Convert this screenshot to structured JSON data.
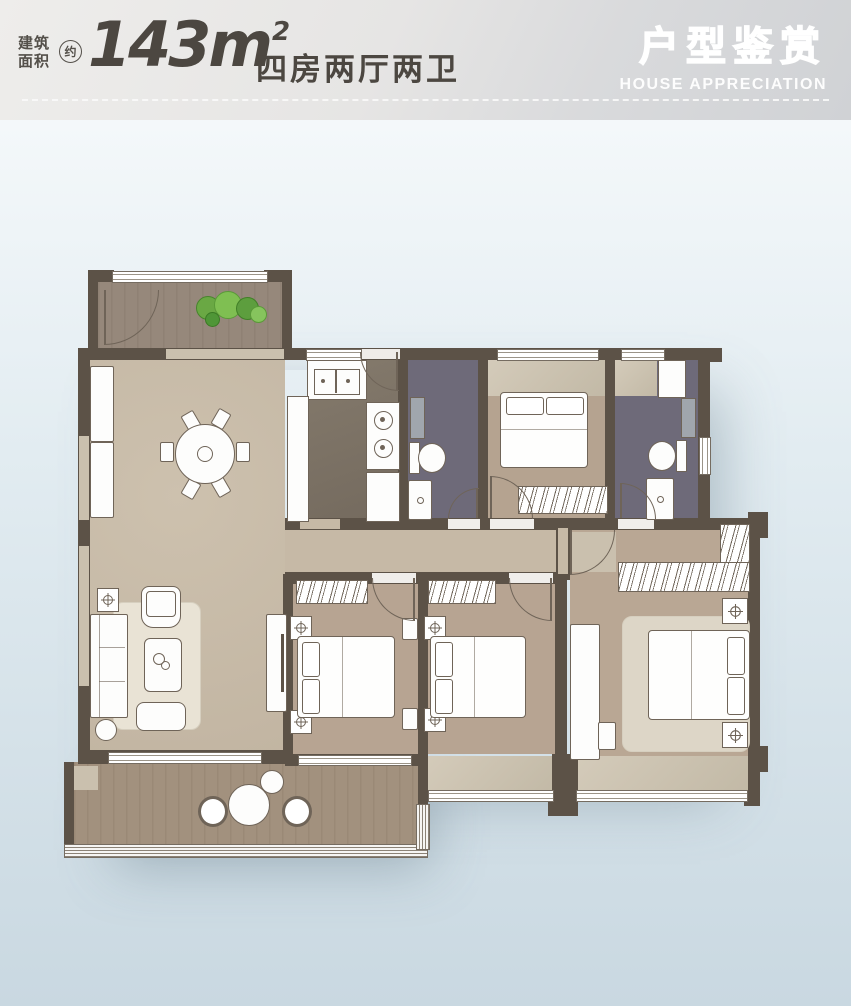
{
  "header": {
    "area_label": [
      "建筑",
      "面积"
    ],
    "approx": "约",
    "area_value": "143m",
    "area_exponent": "2",
    "rooms_summary": "四房两厅两卫",
    "brand_title_cn": "户型鉴赏",
    "brand_title_en": "HOUSE APPRECIATION"
  },
  "colors": {
    "header_bg_top": "#eeedeb",
    "header_bg_bottom": "#d0d2d5",
    "header_text": "#4c4741",
    "page_bg_top": "#f4f8fa",
    "page_bg_bottom": "#c9d8e1",
    "wall": "#5c5247",
    "floor_living": "#c7baa7",
    "floor_bedroom": "#b5a390",
    "floor_bathroom": "#6e6a79",
    "floor_kitchen": "#7b7063",
    "floor_balcony": "#a2917e",
    "bay_sill": "#cdc4b2",
    "furniture_outline": "#6f6458",
    "plant_green": "#6fae45"
  },
  "icons": {
    "fixture": "crosshair-circle-icon",
    "plant": "shrub-cluster-icon"
  }
}
